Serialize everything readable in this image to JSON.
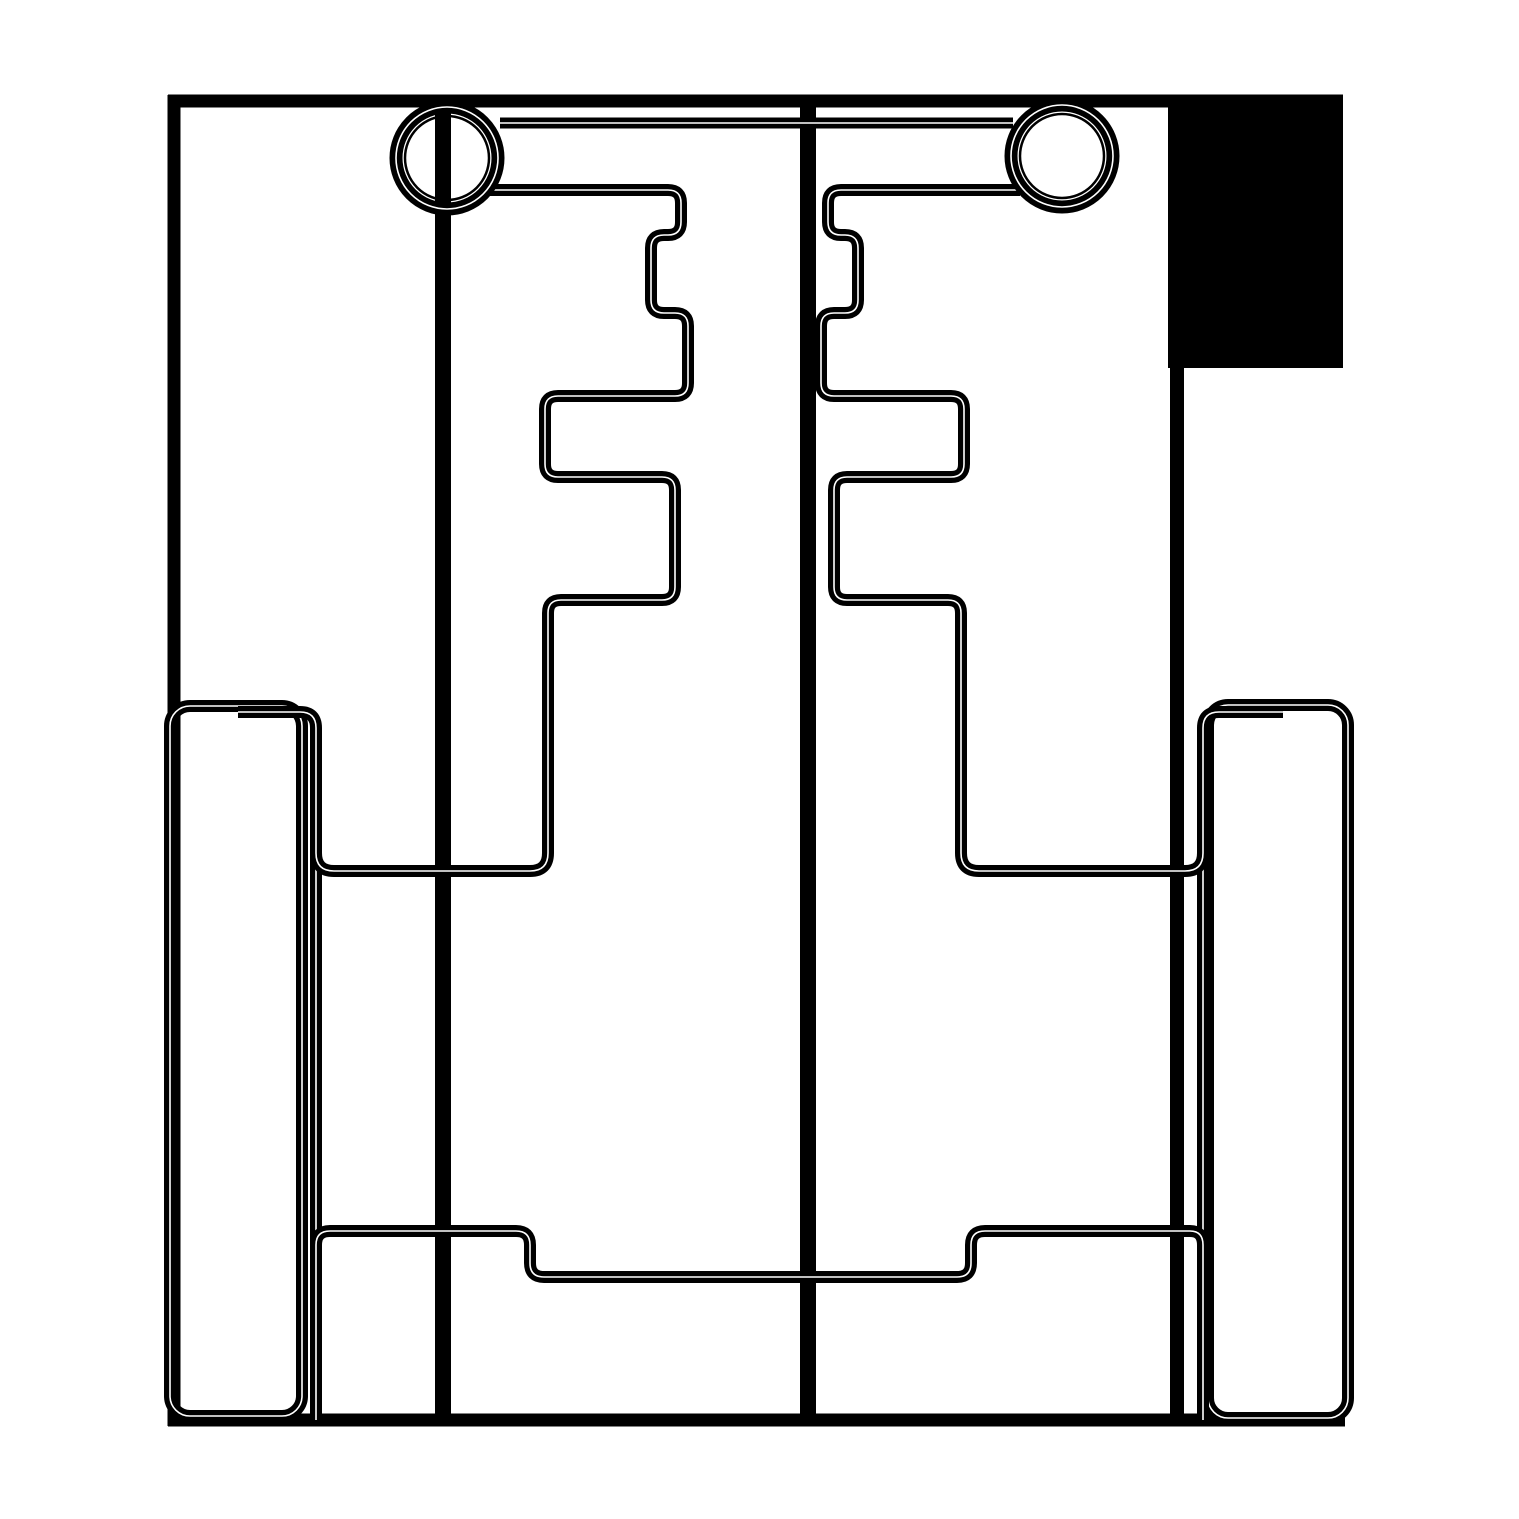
{
  "figure": {
    "kind": "technical-line-drawing",
    "description": "Monochrome pattern/CAD style outline drawing with mirrored stepped profiles, two ringed circles at top, a solid filled block at top right, side rails with rounded corners, and stepped horizontal bands",
    "canvas": {
      "width": 1519,
      "height": 1519,
      "background": "#ffffff",
      "ink": "#000000"
    }
  },
  "shapes": [
    {
      "name": "corner-block",
      "kind": "rect",
      "x": 1168,
      "y": 95,
      "w": 175,
      "h": 273,
      "fill": true,
      "sw": 0,
      "seam": false
    },
    {
      "name": "frame-top-edge",
      "kind": "path",
      "d": "M 168 101 L 1343 101",
      "sw": 13,
      "seam": false
    },
    {
      "name": "frame-left-edge",
      "kind": "path",
      "d": "M 174 95 L 174 1426",
      "sw": 13,
      "seam": false
    },
    {
      "name": "frame-bottom-edge",
      "kind": "path",
      "d": "M 168 1420 L 1345 1420",
      "sw": 13,
      "seam": false
    },
    {
      "name": "grainline-left",
      "kind": "path",
      "d": "M 443 98 L 443 1420",
      "sw": 16,
      "seam": false
    },
    {
      "name": "grainline-center",
      "kind": "path",
      "d": "M 808 98 L 808 1420",
      "sw": 16,
      "seam": false
    },
    {
      "name": "grainline-right",
      "kind": "path",
      "d": "M 1177 360 L 1177 1420",
      "sw": 14,
      "seam": false
    },
    {
      "name": "rail-left",
      "kind": "rrect",
      "x": 170,
      "y": 706,
      "w": 132,
      "h": 710,
      "rx": 20,
      "sw": 12,
      "seam": true
    },
    {
      "name": "rail-right",
      "kind": "rrect",
      "x": 1208,
      "y": 705,
      "w": 140,
      "h": 713,
      "rx": 20,
      "sw": 12,
      "seam": true
    },
    {
      "name": "side-seam-left",
      "kind": "path",
      "d": "M 238 712 L 300 712 Q 316 712 316 728 L 316 1420",
      "sw": 12,
      "seam": true
    },
    {
      "name": "side-seam-right",
      "kind": "path",
      "d": "M 1283 712 L 1219 712 Q 1203 712 1203 728 L 1203 1420",
      "sw": 12,
      "seam": true
    },
    {
      "name": "top-band",
      "kind": "path",
      "d": "M 500 123 L 1013 123",
      "sw": 11,
      "seam": true
    },
    {
      "name": "stepped-profile-left",
      "kind": "path",
      "d": "M 489 190 L 668 190 Q 681 190 681 203 L 681 222 Q 681 235 668 235 L 664 235 Q 651 235 651 248 L 651 300 Q 651 313 664 313 L 675 313 Q 688 313 688 326 L 688 383 Q 688 396 675 396 L 558 396 Q 545 396 545 409 L 545 464 Q 545 477 558 477 L 662 477 Q 675 477 675 490 L 675 587 Q 675 600 662 600 L 561 600 Q 548 600 548 613 L 548 853 Q 548 871 530 871 L 334 871 Q 316 871 316 853 L 316 795",
      "sw": 12,
      "seam": true
    },
    {
      "name": "stepped-profile-right",
      "kind": "path",
      "d": "M 1020 190 L 841 190 Q 828 190 828 203 L 828 222 Q 828 235 841 235 L 845 235 Q 858 235 858 248 L 858 300 Q 858 313 845 313 L 834 313 Q 821 313 821 326 L 821 383 Q 821 396 834 396 L 951 396 Q 964 396 964 409 L 964 464 Q 964 477 951 477 L 847 477 Q 834 477 834 490 L 834 587 Q 834 600 847 600 L 948 600 Q 961 600 961 613 L 961 853 Q 961 871 979 871 L 1185 871 Q 1203 871 1203 853 L 1203 795",
      "sw": 12,
      "seam": true
    },
    {
      "name": "hem-band",
      "kind": "path",
      "d": "M 316 1245 Q 316 1231 330 1231 L 516 1231 Q 530 1231 530 1245 L 530 1263 Q 530 1277 544 1277 L 957 1277 Q 971 1277 971 1263 L 971 1245 Q 971 1231 985 1231 L 1190 1231 Q 1203 1231 1203 1245",
      "sw": 12,
      "seam": true
    },
    {
      "name": "grommet-left-ring",
      "kind": "circle",
      "cx": 447,
      "cy": 158,
      "r": 51,
      "sw": 13,
      "seam": true
    },
    {
      "name": "grommet-left-inner",
      "kind": "circle",
      "cx": 447,
      "cy": 158,
      "r": 42,
      "sw": 2.5,
      "seam": false
    },
    {
      "name": "grommet-right-ring",
      "kind": "circle",
      "cx": 1062,
      "cy": 156,
      "r": 51,
      "sw": 13,
      "seam": true
    },
    {
      "name": "grommet-right-inner",
      "kind": "circle",
      "cx": 1062,
      "cy": 156,
      "r": 42,
      "sw": 2.5,
      "seam": false
    }
  ]
}
